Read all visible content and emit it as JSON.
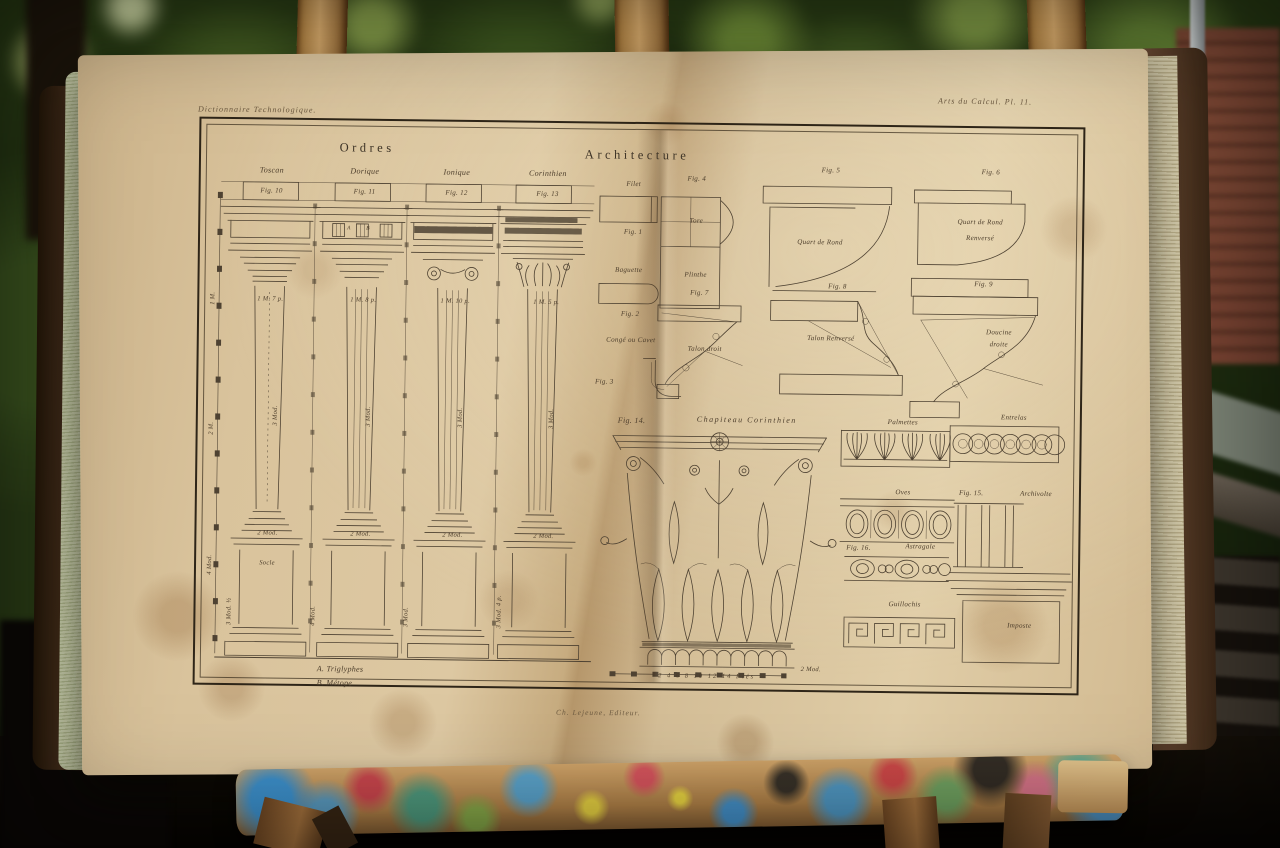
{
  "scene": {
    "setting": "Antique engraved architecture plate in an open book, displayed on a painter's easel outdoors",
    "palette": {
      "foliage": "#2a3d15",
      "page": "#d9c39c",
      "ink": "#4b3c2a",
      "cover": "#4c331f",
      "easel_wood": "#c89a5c",
      "brick": "#7e4534"
    }
  },
  "plate": {
    "running_head_left": "Dictionnaire Technologique.",
    "running_head_right": "Arts du Calcul. Pl. 11.",
    "title_orders": "Ordres",
    "title_architecture": "Architecture",
    "frieze_letters": {
      "a": "A",
      "b": "B"
    },
    "dims_scale": [
      "1 M.",
      "2 M.",
      "4 Mod."
    ],
    "orders": [
      {
        "name": "Toscan",
        "fig": "Fig. 10",
        "cap": "1 M. 7 p.",
        "shaft": "3 Mod.",
        "base": "2 Mod.",
        "dim": "3 Mod. ½",
        "pedestal": "Socle"
      },
      {
        "name": "Dorique",
        "fig": "Fig. 11",
        "cap": "1 M. 8 p.",
        "shaft": "3 Mod.",
        "base": "2 Mod.",
        "dim": "4 Mod."
      },
      {
        "name": "Ionique",
        "fig": "Fig. 12",
        "cap": "1 M. 10 p.",
        "shaft": "3 Mod.",
        "base": "2 Mod.",
        "dim": "3 Mod."
      },
      {
        "name": "Corinthien",
        "fig": "Fig. 13",
        "cap": "1 M. 5 p.",
        "shaft": "3 Mod.",
        "base": "2 Mod.",
        "dim": "3 Mod. 4 p."
      }
    ],
    "fold_figs": [
      {
        "fig": "Fig. 1",
        "label": "Filet"
      },
      {
        "fig": "Fig. 2",
        "label": "Baguette"
      },
      {
        "fig": "Fig. 3",
        "label": "Congé ou Cavet"
      }
    ],
    "row1": [
      {
        "fig": "Fig. 4",
        "a": "Tore",
        "b": "Plinthe"
      },
      {
        "fig": "Fig. 5",
        "a": "Quart de Rond"
      },
      {
        "fig": "Fig. 6",
        "a": "Quart de Rond",
        "b": "Renversé"
      }
    ],
    "row2": [
      {
        "fig": "Fig. 7",
        "a": "Talon droit"
      },
      {
        "fig": "Fig. 8",
        "a": "Talon Renversé"
      },
      {
        "fig": "Fig. 9",
        "a": "Doucine",
        "b": "droite"
      }
    ],
    "fig14": {
      "fig": "Fig. 14.",
      "title": "Chapiteau Corinthien",
      "scale": "2 Mod.",
      "ticks": "2   4   6   8   10   12   14 Piés"
    },
    "orn": {
      "palmettes": "Palmettes",
      "entrelas": "Entrelas",
      "oves": "Oves",
      "fig15": "Fig. 15.",
      "archivolte": "Archivolte",
      "imposte": "Imposte",
      "fig16": "Fig. 16.",
      "astragale": "Astragale",
      "guillochis": "Guillochis"
    },
    "footnote_a": "A. Triglyphes",
    "footnote_b": "B. Métope",
    "imprint": "Ch. Lejeune, Editeur."
  }
}
